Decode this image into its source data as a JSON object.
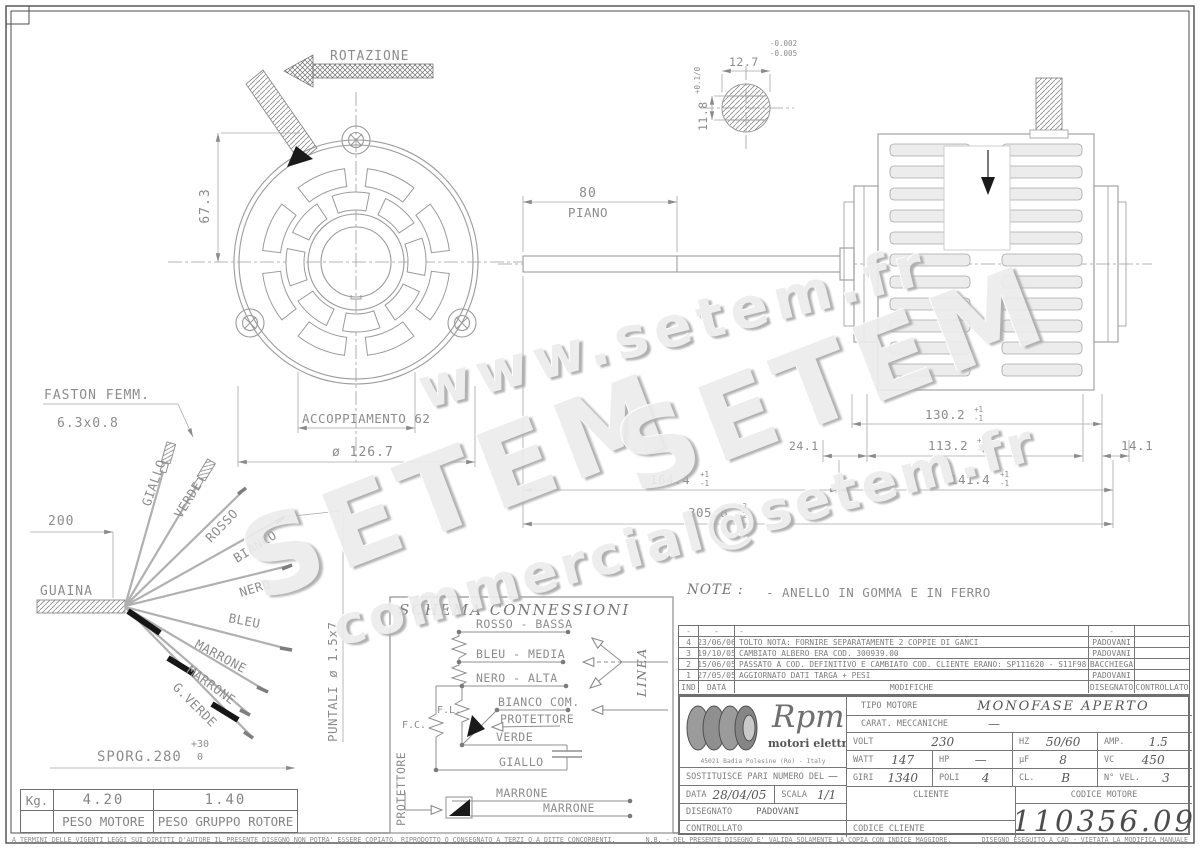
{
  "colors": {
    "line": "#9a9a9a",
    "text": "#8c8c8c",
    "dark": "#555555",
    "black": "#1a1a1a",
    "watermark": "#ececec"
  },
  "watermarks": {
    "top": "www.setem.fr",
    "mid1": "SETEM",
    "mid2": "SETEM",
    "bottom": "commercial@setem.fr"
  },
  "front_view": {
    "rotation": "ROTAZIONE",
    "height_dim": "67.3",
    "coupling": "ACCOPPIAMENTO 62",
    "diameter": "ø 126.7"
  },
  "shaft_detail": {
    "width": "12.7",
    "width_tol_up": "-0.002",
    "width_tol_dn": "-0.005",
    "height": "11.8",
    "height_tol": "+0.1/0"
  },
  "side_view": {
    "flat_len": "80",
    "flat_label": "PIANO",
    "dim_130": "130.2",
    "dim_130_up": "+1",
    "dim_130_dn": "-1",
    "dim_113": "113.2",
    "dim_113_up": "+1",
    "dim_113_dn": "-1",
    "dim_14": "14.1",
    "dim_24": "24.1",
    "dim_164": "164.4",
    "dim_164_up": "+1",
    "dim_164_dn": "-1",
    "dim_141": "141.4",
    "dim_141_up": "+1",
    "dim_141_dn": "-1",
    "dim_305": "305.8",
    "dim_305_up": "+2",
    "dim_305_dn": "-2"
  },
  "cable": {
    "faston1": "FASTON FEMM.",
    "faston2": "6.3x0.8",
    "dim_200": "200",
    "guaina": "GUAINA",
    "wires": [
      "GIALLO",
      "VERDE",
      "ROSSO",
      "BIANCO",
      "NERO",
      "BLEU",
      "MARRONE",
      "MARRONE",
      "G.VERDE"
    ],
    "sporg": "SPORG.280",
    "sporg_up": "+30",
    "sporg_dn": "0",
    "puntali": "PUNTALI ø 1.5x7"
  },
  "weights": {
    "unit": "Kg.",
    "motor": "4.20",
    "rotor": "1.40",
    "motor_label": "PESO MOTORE",
    "rotor_label": "PESO GRUPPO ROTORE"
  },
  "note": {
    "label": "NOTE :",
    "text": "- ANELLO IN GOMMA E IN FERRO"
  },
  "schema": {
    "title": "SCHEMA CONNESSIONI",
    "rosso": "ROSSO - BASSA",
    "bleu": "BLEU - MEDIA",
    "nero": "NERO - ALTA",
    "bianco": "BIANCO COM.",
    "protettore": "PROTETTORE",
    "verde": "VERDE",
    "giallo": "GIALLO",
    "marrone1": "MARRONE",
    "marrone2": "MARRONE",
    "fl": "F.L.",
    "fc": "F.C.",
    "linea": "LINEA",
    "protettore_side": "PROTETTORE"
  },
  "revisions": {
    "col_ind": "IND",
    "col_data": "DATA",
    "col_mod": "MODIFICHE",
    "col_dis": "DISEGNATO",
    "col_con": "CONTROLLATO",
    "rows": [
      {
        "ind": "-",
        "date": "-",
        "text": "-",
        "by": "-",
        "chk": ""
      },
      {
        "ind": "4",
        "date": "23/06/06",
        "text": "TOLTO NOTA: FORNIRE SEPARATAMENTE 2 COPPIE DI GANCI",
        "by": "PADOVANI",
        "chk": ""
      },
      {
        "ind": "3",
        "date": "19/10/05",
        "text": "CAMBIATO ALBERO ERA COD. 300939.00",
        "by": "PADOVANI",
        "chk": ""
      },
      {
        "ind": "2",
        "date": "15/06/05",
        "text": "PASSATO A COD. DEFINITIVO E CAMBIATO COD. CLIENTE ERANO: SP111620 - S11F98",
        "by": "BACCHIEGA",
        "chk": ""
      },
      {
        "ind": "1",
        "date": "27/05/05",
        "text": "AGGIORNATO DATI TARGA + PESI",
        "by": "PADOVANI",
        "chk": ""
      }
    ]
  },
  "titleblock": {
    "brand": "Rpm",
    "brand_sub": "motori elettrici",
    "address": "45021 Badia Polesine (Ro) - Italy",
    "tipo_label": "TIPO MOTORE",
    "tipo_value": "MONOFASE APERTO",
    "carat_label": "CARAT. MECCANICHE",
    "carat_value": "—",
    "volt_label": "VOLT",
    "volt_value": "230",
    "hz_label": "HZ",
    "hz_value": "50/60",
    "amp_label": "AMP.",
    "amp_value": "1.5",
    "watt_label": "WATT",
    "watt_value": "147",
    "hp_label": "HP",
    "hp_value": "—",
    "uf_label": "μF",
    "uf_value": "8",
    "vc_label": "VC",
    "vc_value": "450",
    "giri_label": "GIRI",
    "giri_value": "1340",
    "poli_label": "POLI",
    "poli_value": "4",
    "cl_label": "CL.",
    "cl_value": "B",
    "nvel_label": "N° VEL.",
    "nvel_value": "3",
    "sost_label": "SOSTITUISCE PARI NUMERO DEL",
    "sost_value": "—",
    "data_label": "DATA",
    "data_value": "28/04/05",
    "scala_label": "SCALA",
    "scala_value": "1/1",
    "dis_label": "DISEGNATO",
    "dis_value": "PADOVANI",
    "con_label": "CONTROLLATO",
    "cliente_label": "CLIENTE",
    "codmot_label": "CODICE MOTORE",
    "codcli_label": "CODICE CLIENTE",
    "codice_motore": "110356.09"
  },
  "footer": {
    "left": "A TERMINI DELLE VIGENTI LEGGI SUI DIRITTI D'AUTORE IL PRESENTE DISEGNO NON POTRA' ESSERE COPIATO, RIPRODOTTO O CONSEGNATO A TERZI O A DITTE CONCORRENTI,",
    "mid": "N.B. - DEL PRESENTE DISEGNO E' VALIDA SOLAMENTE LA COPIA CON INDICE MAGGIORE.",
    "right": "DISEGNO ESEGUITO A CAD - VIETATA LA MODIFICA MANUALE"
  }
}
